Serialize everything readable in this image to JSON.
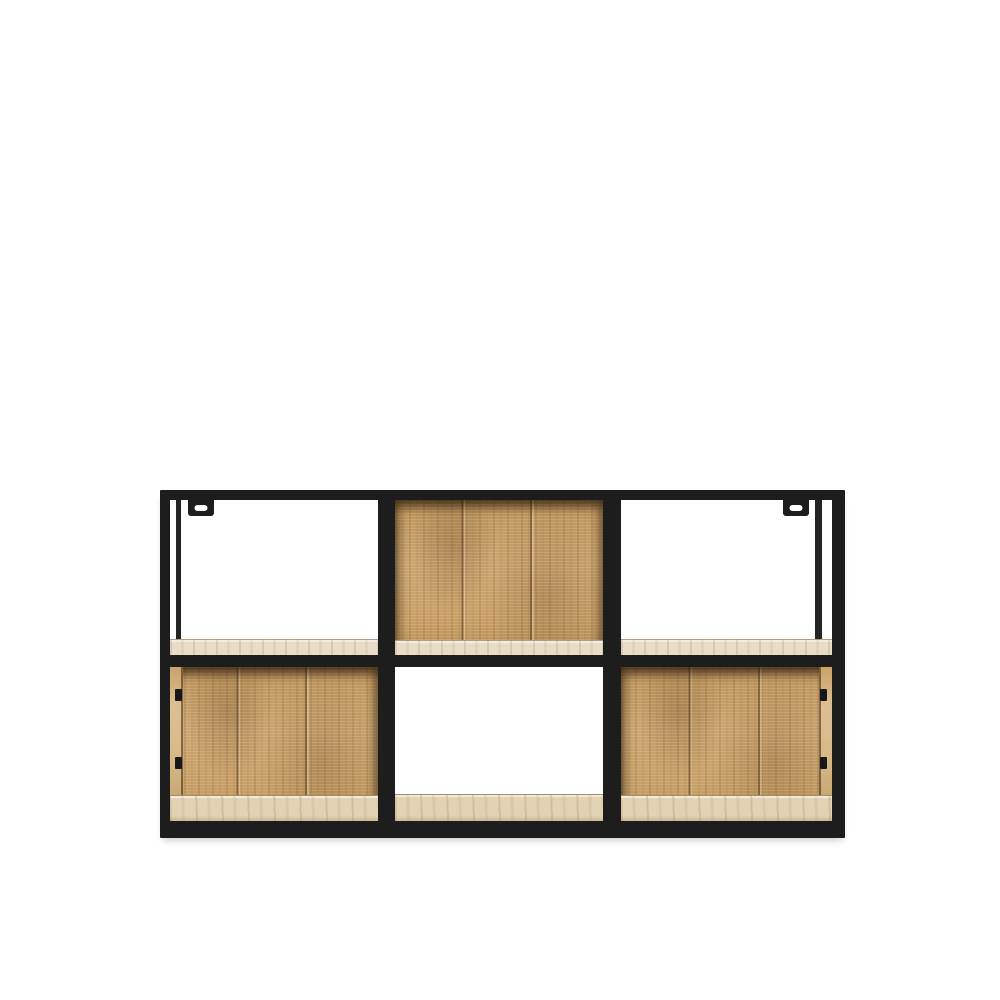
{
  "page": {
    "background_color": "#ffffff"
  },
  "product": {
    "name": "Industrial cube wall shelf",
    "description": "Rectangular wall shelf with black metal frame and mango wood panels, 3 columns by 2 rows of cubes",
    "frame_material": "black metal",
    "panel_material": "mango wood",
    "rows": 2,
    "columns": 3,
    "mounting_brackets": 2
  },
  "colors": {
    "background": "#ffffff",
    "frame": "#1d1d1d",
    "wood_mid": "#c89f67",
    "wood_dark": "#8f6a3c",
    "wood_light": "#dfc293",
    "shelf_surface_top": "#e8ddc6",
    "shelf_surface_bottom": "#e2d3b4"
  },
  "shelf": {
    "cells": [
      {
        "id": "top-left",
        "row": 0,
        "col": 0,
        "back_panel": false,
        "back_post": "left",
        "shelf_strip": 16,
        "side_strip": null
      },
      {
        "id": "top-middle",
        "row": 0,
        "col": 1,
        "back_panel": true,
        "back_post": null,
        "shelf_strip": 15,
        "side_strip": null
      },
      {
        "id": "top-right",
        "row": 0,
        "col": 2,
        "back_panel": false,
        "back_post": "right",
        "shelf_strip": 16,
        "side_strip": null
      },
      {
        "id": "bottom-left",
        "row": 1,
        "col": 0,
        "back_panel": true,
        "back_post": null,
        "shelf_strip": 26,
        "side_strip": "left"
      },
      {
        "id": "bottom-middle",
        "row": 1,
        "col": 1,
        "back_panel": false,
        "back_post": null,
        "shelf_strip": 27,
        "side_strip": null
      },
      {
        "id": "bottom-right",
        "row": 1,
        "col": 2,
        "back_panel": true,
        "back_post": null,
        "shelf_strip": 26,
        "side_strip": "right"
      }
    ],
    "brackets": [
      {
        "position": "top-left"
      },
      {
        "position": "top-right"
      }
    ]
  }
}
